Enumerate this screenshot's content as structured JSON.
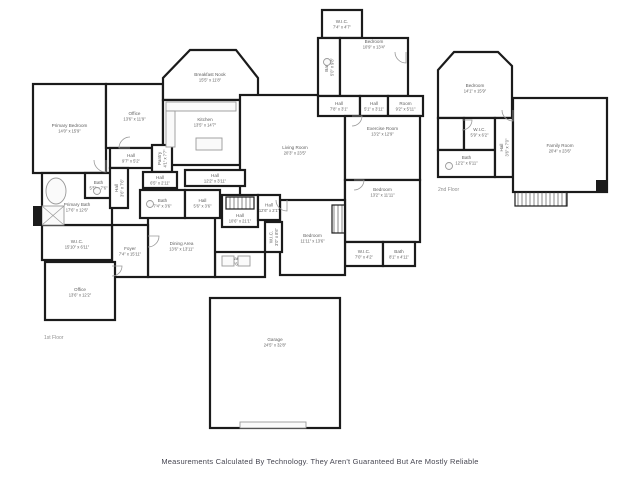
{
  "footer": {
    "disclaimer": "Measurements Calculated By Technology. They Aren't Guaranteed But Are Mostly Reliable"
  },
  "floorplan": {
    "colors": {
      "wall": "#1b1b1b",
      "label": "#5f5f5f",
      "fixture": "#9a9a9a",
      "floor_label": "#8f8f8f",
      "footer_text": "#474752"
    },
    "floor_labels": [
      {
        "text": "1st Floor",
        "x": 44,
        "y": 339
      },
      {
        "text": "2nd Floor",
        "x": 438,
        "y": 191
      }
    ],
    "rooms": [
      {
        "id": "primary-bedroom",
        "name": "Primary Bedroom",
        "dims": "14'0\" x 15'9\"",
        "x": 33,
        "y": 84,
        "w": 73,
        "h": 89,
        "ly": 128
      },
      {
        "id": "office-1",
        "name": "Office",
        "dims": "13'6\" x 11'9\"",
        "x": 106,
        "y": 84,
        "w": 57,
        "h": 64,
        "ly": 116
      },
      {
        "id": "breakfast-nook",
        "name": "Breakfast Nook",
        "dims": "15'5\" x 11'8\"",
        "points": [
          [
            163,
            100
          ],
          [
            163,
            78
          ],
          [
            190,
            50
          ],
          [
            236,
            50
          ],
          [
            258,
            78
          ],
          [
            258,
            100
          ]
        ],
        "lx": 210,
        "ly": 77
      },
      {
        "id": "kitchen",
        "name": "Kitchen",
        "dims": "13'5\" x 14'7\"",
        "x": 163,
        "y": 100,
        "w": 77,
        "h": 65,
        "lx": 205,
        "ly": 122
      },
      {
        "id": "living-room",
        "name": "Living Room",
        "dims": "20'3\" x 23'5\"",
        "x": 240,
        "y": 95,
        "w": 105,
        "h": 110,
        "lx": 295,
        "ly": 150
      },
      {
        "id": "wic-1",
        "name": "W.I.C.",
        "dims": "7'4\" x 4'7\"",
        "x": 322,
        "y": 10,
        "w": 40,
        "h": 28
      },
      {
        "id": "bath-1",
        "name": "Bath",
        "dims": "5'0\" x 9'8\"",
        "x": 318,
        "y": 38,
        "w": 22,
        "h": 58,
        "rot": true
      },
      {
        "id": "bedroom-1",
        "name": "Bedroom",
        "dims": "10'9\" x 13'4\"",
        "x": 340,
        "y": 38,
        "w": 68,
        "h": 58,
        "ly": 44
      },
      {
        "id": "hall-1",
        "name": "Hall",
        "dims": "7'8\" x 3'1\"",
        "x": 318,
        "y": 96,
        "w": 42,
        "h": 20
      },
      {
        "id": "hall-2",
        "name": "Hall",
        "dims": "5'1\" x 3'11\"",
        "x": 360,
        "y": 96,
        "w": 28,
        "h": 20
      },
      {
        "id": "room-1",
        "name": "Room",
        "dims": "9'2\" x 5'11\"",
        "x": 388,
        "y": 96,
        "w": 35,
        "h": 20
      },
      {
        "id": "exercise-room",
        "name": "Exercise Room",
        "dims": "13'2\" x 12'9\"",
        "x": 345,
        "y": 116,
        "w": 75,
        "h": 64,
        "ly": 131
      },
      {
        "id": "bedroom-2",
        "name": "Bedroom",
        "dims": "13'2\" x 11'11\"",
        "x": 345,
        "y": 180,
        "w": 75,
        "h": 62,
        "ly": 192
      },
      {
        "id": "wic-2",
        "name": "W.I.C.",
        "dims": "7'0\" x 4'2\"",
        "x": 345,
        "y": 242,
        "w": 38,
        "h": 24
      },
      {
        "id": "bath-2",
        "name": "Bath",
        "dims": "8'1\" x 4'11\"",
        "x": 383,
        "y": 242,
        "w": 32,
        "h": 24
      },
      {
        "id": "bedroom-3",
        "name": "Bedroom",
        "dims": "11'11\" x 13'6\"",
        "x": 280,
        "y": 200,
        "w": 65,
        "h": 75,
        "ly": 238
      },
      {
        "id": "hall-3",
        "name": "Hall",
        "dims": "10'6\" x 21'1\"",
        "x": 222,
        "y": 195,
        "w": 36,
        "h": 32,
        "lx": 240,
        "ly": 218
      },
      {
        "id": "hall-4",
        "name": "Hall",
        "dims": "12'6\" x 2'1\"",
        "x": 258,
        "y": 195,
        "w": 22,
        "h": 25
      },
      {
        "id": "wic-3",
        "name": "W.I.C.",
        "dims": "3'0\" x 8'6\"",
        "x": 265,
        "y": 222,
        "w": 17,
        "h": 30,
        "rot": true
      },
      {
        "id": "laundry",
        "name": "Laundry",
        "dims": "10'6\" x 4'6\"",
        "x": 215,
        "y": 252,
        "w": 50,
        "h": 25,
        "ly": 261
      },
      {
        "id": "dining-area",
        "name": "Dining Area",
        "dims": "13'6\" x 13'11\"",
        "x": 148,
        "y": 213,
        "w": 67,
        "h": 64,
        "ly": 246
      },
      {
        "id": "foyer",
        "name": "Foyer",
        "dims": "7'4\" x 15'11\"",
        "x": 112,
        "y": 225,
        "w": 36,
        "h": 52,
        "ly": 251
      },
      {
        "id": "wic-4",
        "name": "W.I.C.",
        "dims": "15'10\" x 6'11\"",
        "x": 42,
        "y": 225,
        "w": 70,
        "h": 35,
        "ly": 244
      },
      {
        "id": "primary-bath",
        "name": "Primary Bath",
        "dims": "17'6\" x 12'6\"",
        "x": 42,
        "y": 173,
        "w": 70,
        "h": 52,
        "ly": 207
      },
      {
        "id": "bath-3",
        "name": "Bath",
        "dims": "5'5\" x 7'6\"",
        "x": 85,
        "y": 173,
        "w": 27,
        "h": 25,
        "ly": 185
      },
      {
        "id": "office-2",
        "name": "Office",
        "dims": "13'6\" x 12'2\"",
        "x": 45,
        "y": 262,
        "w": 70,
        "h": 58,
        "ly": 292
      },
      {
        "id": "hall-5",
        "name": "Hall",
        "dims": "9'7\" x 5'2\"",
        "x": 110,
        "y": 148,
        "w": 42,
        "h": 20
      },
      {
        "id": "pantry",
        "name": "Pantry",
        "dims": "4'1\" x 7'7\"",
        "x": 152,
        "y": 145,
        "w": 20,
        "h": 27,
        "rot": true
      },
      {
        "id": "hall-6",
        "name": "Hall",
        "dims": "3'6\" x 7'6\"",
        "x": 110,
        "y": 168,
        "w": 18,
        "h": 40,
        "rot": true
      },
      {
        "id": "hall-7",
        "name": "Hall",
        "dims": "6'5\" x 2'11\"",
        "x": 143,
        "y": 172,
        "w": 34,
        "h": 16
      },
      {
        "id": "hall-8",
        "name": "Hall",
        "dims": "12'2\" x 3'11\"",
        "x": 185,
        "y": 170,
        "w": 60,
        "h": 16
      },
      {
        "id": "bath-4",
        "name": "Bath",
        "dims": "7'4\" x 3'6\"",
        "x": 140,
        "y": 190,
        "w": 45,
        "h": 28,
        "ly": 203
      },
      {
        "id": "hall-9",
        "name": "Hall",
        "dims": "5'6\" x 3'6\"",
        "x": 185,
        "y": 190,
        "w": 35,
        "h": 28,
        "ly": 203
      },
      {
        "id": "garage",
        "name": "Garage",
        "dims": "24'5\" x 32'8\"",
        "x": 210,
        "y": 298,
        "w": 130,
        "h": 130,
        "ly": 342
      },
      {
        "id": "bedroom-4",
        "name": "Bedroom",
        "dims": "14'1\" x 15'9\"",
        "points": [
          [
            438,
            118
          ],
          [
            438,
            70
          ],
          [
            454,
            52
          ],
          [
            498,
            52
          ],
          [
            512,
            66
          ],
          [
            512,
            118
          ]
        ],
        "lx": 475,
        "ly": 88
      },
      {
        "id": "closet-2f",
        "name": "",
        "dims": "",
        "x": 438,
        "y": 118,
        "w": 26,
        "h": 32
      },
      {
        "id": "wic-5",
        "name": "W.I.C.",
        "dims": "5'9\" x 6'2\"",
        "x": 464,
        "y": 118,
        "w": 31,
        "h": 32,
        "ly": 132
      },
      {
        "id": "bath-5",
        "name": "Bath",
        "dims": "12'2\" x 6'11\"",
        "x": 438,
        "y": 150,
        "w": 57,
        "h": 27,
        "ly": 160
      },
      {
        "id": "hall-10",
        "name": "Hall",
        "dims": "3'6\" x 7'0\"",
        "x": 495,
        "y": 118,
        "w": 18,
        "h": 59,
        "rot": true
      },
      {
        "id": "family-room",
        "name": "Family Room",
        "dims": "20'4\" x 23'6\"",
        "x": 513,
        "y": 98,
        "w": 94,
        "h": 94,
        "ly": 148
      }
    ],
    "stairs": [
      {
        "x": 226,
        "y": 197,
        "w": 28,
        "h": 12
      },
      {
        "x": 332,
        "y": 205,
        "w": 13,
        "h": 28
      },
      {
        "x": 515,
        "y": 192,
        "w": 52,
        "h": 14
      }
    ],
    "doors": [
      {
        "hx": 106,
        "hy": 160,
        "r": 12,
        "rot": 90
      },
      {
        "hx": 130,
        "hy": 148,
        "r": 11,
        "rot": 180
      },
      {
        "hx": 148,
        "hy": 236,
        "r": 11,
        "rot": 0
      },
      {
        "hx": 287,
        "hy": 200,
        "r": 11,
        "rot": 90
      },
      {
        "hx": 352,
        "hy": 116,
        "r": 10,
        "rot": 0
      },
      {
        "hx": 354,
        "hy": 180,
        "r": 10,
        "rot": 0
      },
      {
        "hx": 406,
        "hy": 52,
        "r": 11,
        "rot": 90
      },
      {
        "hx": 462,
        "hy": 120,
        "r": 10,
        "rot": 0
      },
      {
        "hx": 513,
        "hy": 110,
        "r": 11,
        "rot": 90
      },
      {
        "hx": 112,
        "hy": 266,
        "r": 10,
        "rot": 0
      }
    ],
    "fixtures": [
      {
        "t": "e",
        "cx": 56,
        "cy": 191,
        "rx": 10,
        "ry": 13,
        "name": "bathtub-icon"
      },
      {
        "t": "x",
        "x": 42,
        "y": 206,
        "w": 22,
        "h": 19,
        "name": "shower-icon"
      },
      {
        "t": "r",
        "x": 166,
        "y": 102,
        "w": 70,
        "h": 9,
        "name": "kitchen-counter-icon"
      },
      {
        "t": "r",
        "x": 166,
        "y": 111,
        "w": 9,
        "h": 36,
        "name": "kitchen-counter-icon"
      },
      {
        "t": "r",
        "x": 196,
        "y": 138,
        "w": 26,
        "h": 12,
        "name": "kitchen-island-icon"
      },
      {
        "t": "c",
        "cx": 97,
        "cy": 191,
        "r": 3.5,
        "name": "toilet-icon"
      },
      {
        "t": "c",
        "cx": 150,
        "cy": 204,
        "r": 3.5,
        "name": "toilet-icon"
      },
      {
        "t": "c",
        "cx": 327,
        "cy": 62,
        "r": 3.5,
        "name": "toilet-icon"
      },
      {
        "t": "c",
        "cx": 449,
        "cy": 166,
        "r": 3.5,
        "name": "toilet-icon"
      },
      {
        "t": "r",
        "x": 222,
        "y": 256,
        "w": 12,
        "h": 10,
        "name": "washer-icon"
      },
      {
        "t": "r",
        "x": 238,
        "y": 256,
        "w": 12,
        "h": 10,
        "name": "dryer-icon"
      },
      {
        "t": "r",
        "x": 240,
        "y": 422,
        "w": 66,
        "h": 6,
        "name": "garage-door-icon"
      },
      {
        "t": "b",
        "x": 33,
        "y": 206,
        "w": 9,
        "h": 20,
        "name": "chimney-block"
      },
      {
        "t": "b",
        "x": 596,
        "y": 180,
        "w": 11,
        "h": 13,
        "name": "chimney-block"
      }
    ]
  }
}
